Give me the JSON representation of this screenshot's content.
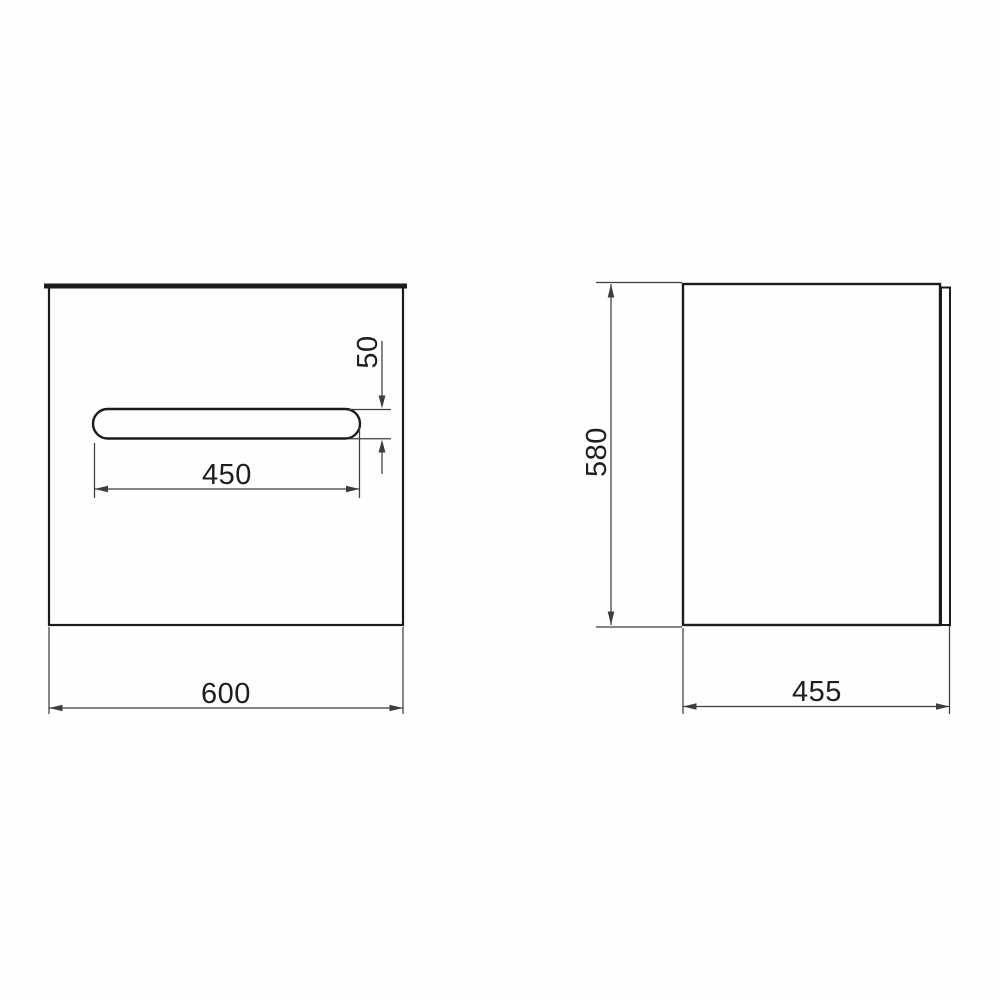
{
  "colors": {
    "background": "#fefefe",
    "outline": "#1b1b1b",
    "dimension": "#3d3d3d",
    "label": "#1e1e1e"
  },
  "front_view": {
    "width_label": "600",
    "handle_width_label": "450",
    "handle_height_label": "50"
  },
  "side_view": {
    "height_label": "580",
    "depth_label": "455"
  }
}
